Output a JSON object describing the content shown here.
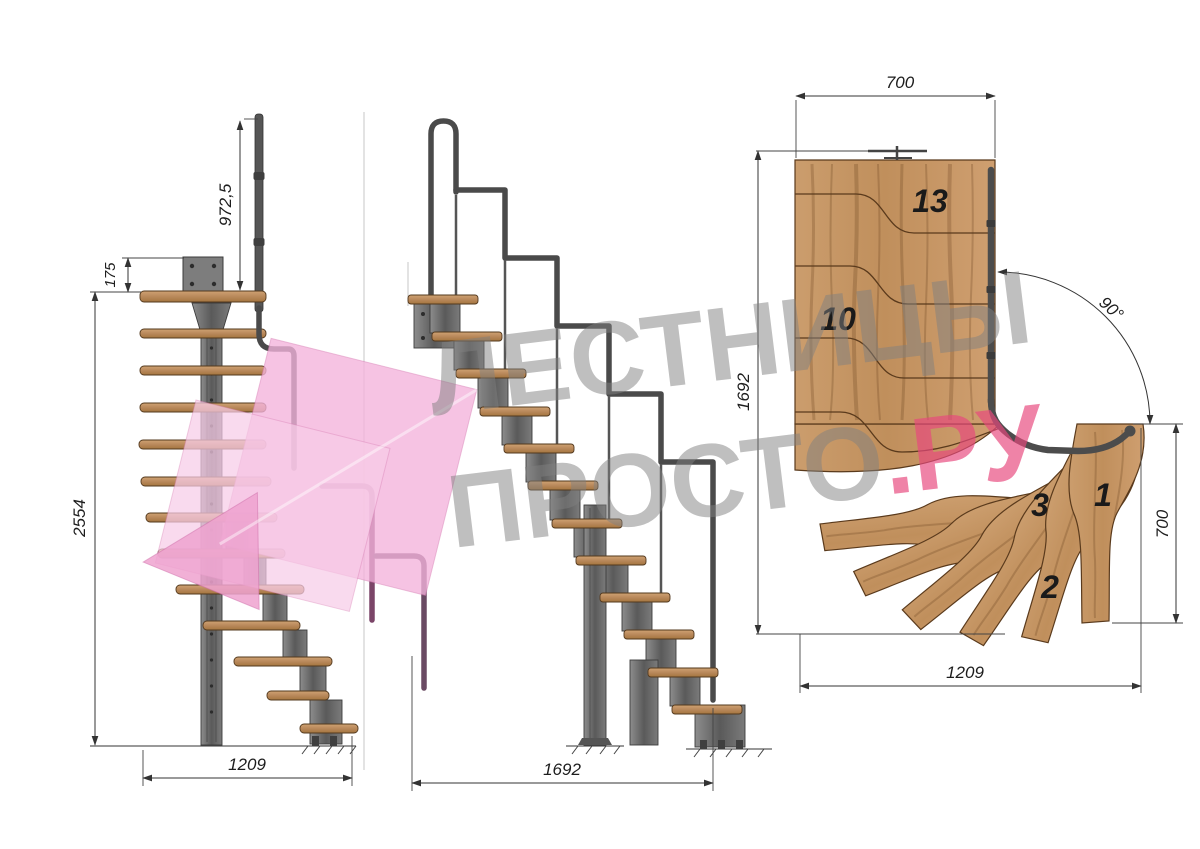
{
  "front_view": {
    "dim_rail_height": "972,5",
    "dim_plate_offset": "175",
    "dim_total_height": "2554",
    "dim_width": "1209"
  },
  "side_view": {
    "dim_length": "1692"
  },
  "plan_view": {
    "dim_top_width": "700",
    "dim_left_length": "1692",
    "dim_angle": "90°",
    "dim_right_width": "700",
    "dim_bottom_length": "1209",
    "step_labels": {
      "step_13": "13",
      "step_10": "10",
      "step_3": "3",
      "step_1": "1",
      "step_2": "2"
    }
  },
  "watermark": {
    "title_line": "ЛЕСТНИЦЫ",
    "brand_gray": "ПРОСТО",
    "brand_pink": ".РУ"
  },
  "colors": {
    "wood": "#c79868",
    "steel": "#6f6f6f",
    "rail": "#4a4a4a",
    "rail_purple": "#7b4568",
    "dimension": "#333333",
    "watermark_gray": "#8a8a8a",
    "watermark_pink": "#e7487d",
    "logo_pink": "#f4b3dc"
  }
}
